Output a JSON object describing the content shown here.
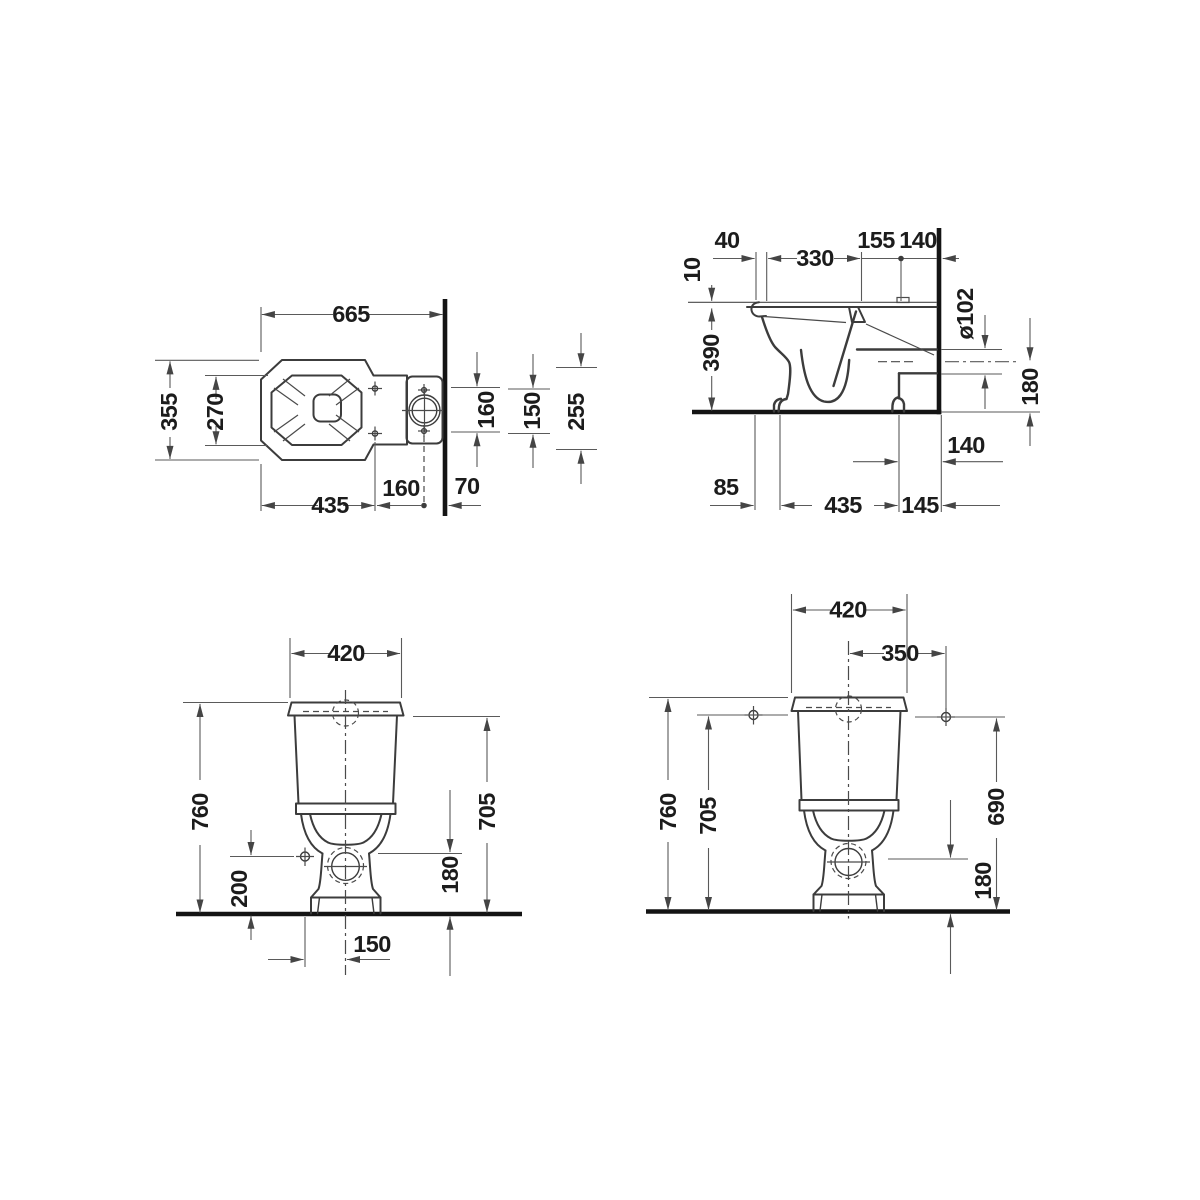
{
  "palette": {
    "background": "#ffffff",
    "object_line": "#3c3c3c",
    "dimension_line": "#5a5a5a",
    "heavy_line": "#141414",
    "text": "#1c1c1c"
  },
  "views": {
    "plan": {
      "dims": {
        "overall_width": "665",
        "overall_depth": "355",
        "inner_depth": "270",
        "bowl_length": "435",
        "flush_offset": "160",
        "wall_offset": "70",
        "fix_spacing_a": "160",
        "fix_spacing_b": "150",
        "side_extent": "255"
      }
    },
    "side": {
      "dims": {
        "front_edge": "40",
        "seat_depth": "330",
        "hinge_offset": "155",
        "hinge_wall": "140",
        "seat_thickness": "10",
        "rim_height": "390",
        "outlet_dia": "ø102",
        "outlet_axis_height": "180",
        "outlet_wall": "140",
        "foot_front": "85",
        "base_length": "435",
        "base_wall": "145"
      }
    },
    "front": {
      "dims": {
        "tank_width": "420",
        "total_height": "760",
        "tank_top_height": "705",
        "side_fix_height": "200",
        "outlet_height": "180",
        "side_fix_offset": "150"
      }
    },
    "front_wall": {
      "dims": {
        "tank_width": "420",
        "wall_fix_spacing": "350",
        "total_height": "760",
        "tank_top_height": "705",
        "wall_fix_height": "690",
        "outlet_height": "180"
      }
    }
  }
}
